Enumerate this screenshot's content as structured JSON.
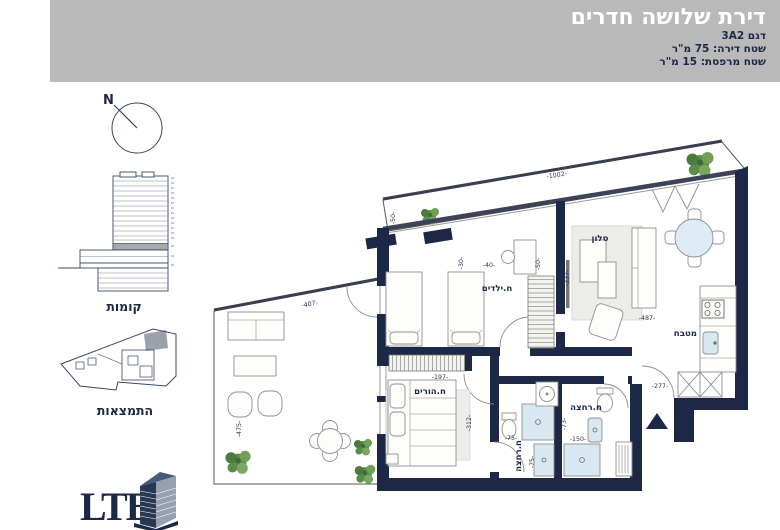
{
  "colors": {
    "navy": "#1d2847",
    "header_bg": "#b9b9b9",
    "deck": "#d9d5cc",
    "deck_line": "#b3afa6",
    "water": "#d8e8f1",
    "green": "#5b8c4a",
    "rug": "#ecece9"
  },
  "header": {
    "title": "דירת שלושה חדרים",
    "model": "דגם 3A2",
    "apartment_area": "שטח דירה: 75 מ\"ר",
    "balcony_area": "שטח מרפסת: 15 מ\"ר"
  },
  "sidebar": {
    "north_label": "N",
    "floors_caption": "קומות",
    "orientation_caption": "התמצאות",
    "logo_text": "LTB"
  },
  "plan": {
    "rooms": {
      "living": "סלון",
      "kids": "ח.ילדים",
      "parents": "ח.הורים",
      "kitchen": "מטבח",
      "bath1": "ח.רחצה",
      "bath2": "ח.רחצה"
    },
    "dims": {
      "top_balcony_length": "-1002-",
      "top_balcony_depth": "-50-",
      "kids_window": "-40-",
      "kids_depth": "-30-",
      "closet_depth": "-50-",
      "living_width": "-487-",
      "living_depth": "-337-",
      "balcony_width": "-407-",
      "balcony_depth": "-475-",
      "parents_width": "-197-",
      "parents_depth": "-312-",
      "bath1_width": "-75-",
      "bath1_depth": "-75-",
      "bath2_depth": "-73-",
      "bath2_width": "-150-",
      "entry_width": "-277-"
    }
  }
}
